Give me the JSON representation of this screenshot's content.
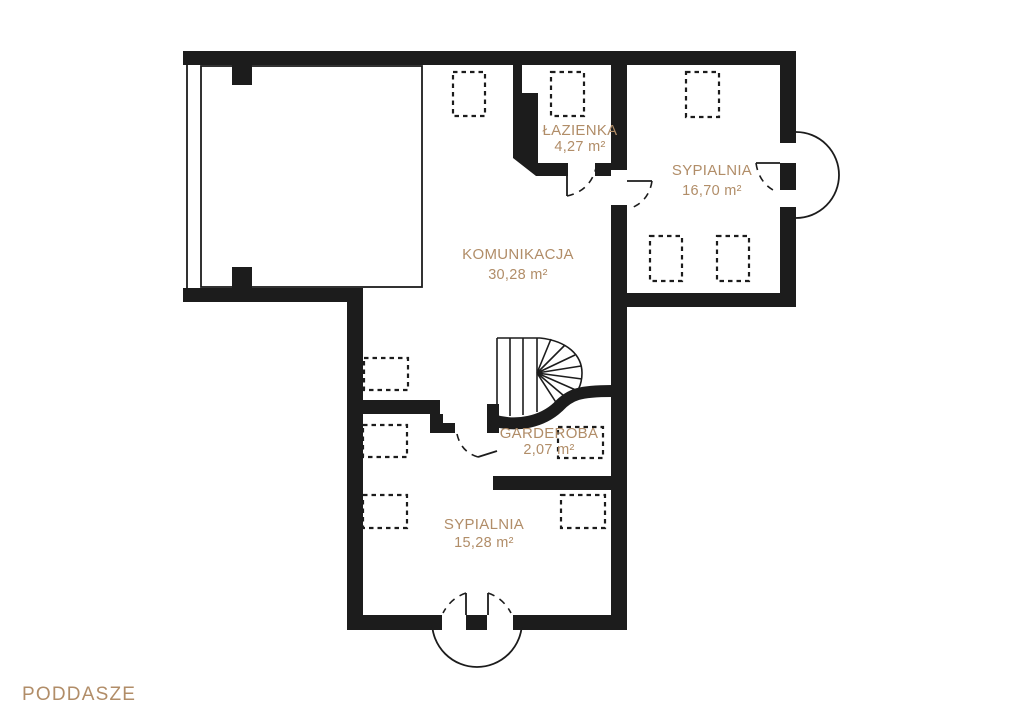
{
  "floor": {
    "label": "PODDASZE"
  },
  "palette": {
    "wall_color": "#1c1c1c",
    "label_color": "#b18d68",
    "background": "#ffffff"
  },
  "rooms": [
    {
      "name": "ŁAZIENKA",
      "area": "4,27 m²"
    },
    {
      "name": "SYPIALNIA",
      "area": "16,70 m²"
    },
    {
      "name": "KOMUNIKACJA",
      "area": "30,28 m²"
    },
    {
      "name": "GARDEROBA",
      "area": "2,07 m²"
    },
    {
      "name": "SYPIALNIA",
      "area": "15,28 m²"
    }
  ],
  "symbols": {
    "roof_window_icon": "dashed-rectangle",
    "door_swing_icon": "quarter-arc",
    "balcony_door_icon": "semicircle-arc",
    "staircase_icon": "winder-stairs",
    "roof_window_count": 10,
    "door_count": 5
  }
}
